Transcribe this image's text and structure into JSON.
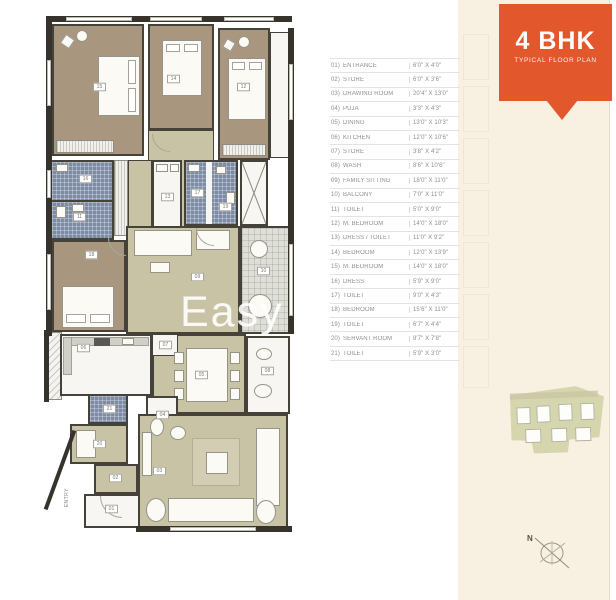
{
  "header": {
    "title": "4 BHK",
    "subtitle": "TYPICAL FLOOR PLAN"
  },
  "legend": {
    "rows": [
      {
        "no": "01)",
        "name": "ENTRANCE",
        "size": "6'0\" X 4'0\""
      },
      {
        "no": "02)",
        "name": "STORE",
        "size": "6'0\" X 3'6\""
      },
      {
        "no": "03)",
        "name": "DRAWING ROOM",
        "size": "20'4\" X 13'0\""
      },
      {
        "no": "04)",
        "name": "PUJA",
        "size": "3'3\" X 4'3\""
      },
      {
        "no": "05)",
        "name": "DINING",
        "size": "13'0\" X 10'3\""
      },
      {
        "no": "06)",
        "name": "KITCHEN",
        "size": "12'0\" X 10'6\""
      },
      {
        "no": "07)",
        "name": "STORE",
        "size": "3'8\" X 4'2\""
      },
      {
        "no": "08)",
        "name": "WASH",
        "size": "8'6\" X 10'6\""
      },
      {
        "no": "09)",
        "name": "FAMILY SITTING",
        "size": "18'0\" X 11'0\""
      },
      {
        "no": "10)",
        "name": "BALCONY",
        "size": "7'0\" X 11'0\""
      },
      {
        "no": "11)",
        "name": "TOILET",
        "size": "5'0\" X 9'0\""
      },
      {
        "no": "12)",
        "name": "M. BEDROOM",
        "size": "14'0\" X 18'0\""
      },
      {
        "no": "13)",
        "name": "DRESS / TOILET",
        "size": "11'0\" X 9'2\""
      },
      {
        "no": "14)",
        "name": "BEDROOM",
        "size": "12'0\" X 13'9\""
      },
      {
        "no": "15)",
        "name": "M. BEDROOM",
        "size": "14'0\" X 18'0\""
      },
      {
        "no": "16)",
        "name": "DRESS",
        "size": "5'9\" X 9'0\""
      },
      {
        "no": "17)",
        "name": "TOILET",
        "size": "9'0\" X 4'3\""
      },
      {
        "no": "18)",
        "name": "BEDROOM",
        "size": "15'6\" X 11'0\""
      },
      {
        "no": "19)",
        "name": "TOILET",
        "size": "6'7\" X 4'4\""
      },
      {
        "no": "20)",
        "name": "SERVANT ROOM",
        "size": "8'7\" X 7'8\""
      },
      {
        "no": "21)",
        "name": "TOILET",
        "size": "5'9\" X 3'0\""
      }
    ]
  },
  "plan": {
    "entry_label": "ENTRY",
    "labels": [
      "15",
      "14",
      "12",
      "16",
      "11",
      "13",
      "17",
      "19",
      "18",
      "09",
      "10",
      "08",
      "06",
      "07",
      "05",
      "04",
      "21",
      "20",
      "02",
      "01",
      "03"
    ]
  },
  "compass": {
    "label": "N"
  },
  "watermark": {
    "text": "Easy"
  },
  "colors": {
    "accent_orange": "#e2572b",
    "bedroom_floor": "#a8977e",
    "living_floor": "#c9c3a6",
    "toilet_floor": "#7d8ca4",
    "wall": "#454239",
    "cream_panel": "#f8f0e0"
  }
}
